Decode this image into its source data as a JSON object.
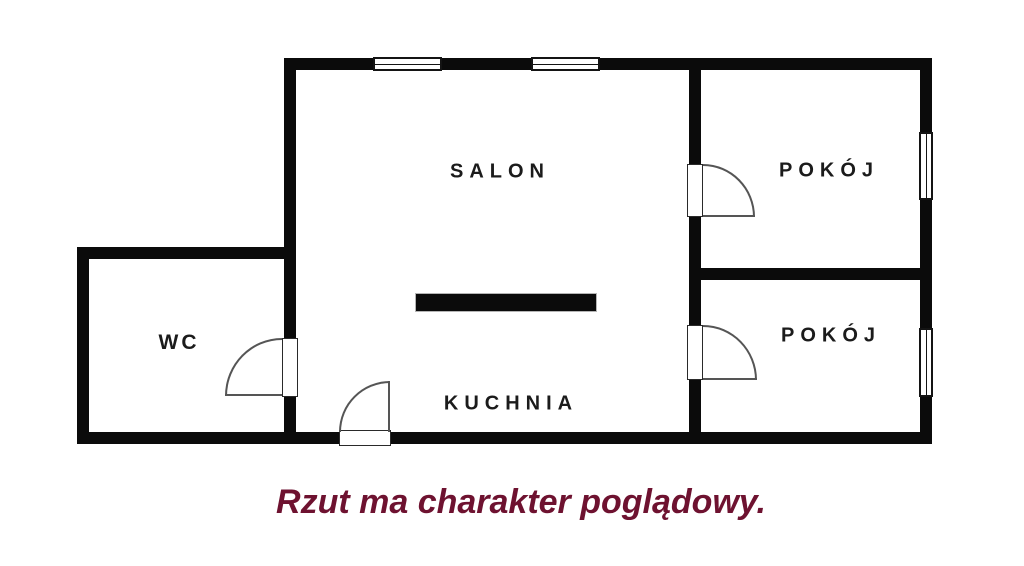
{
  "plan": {
    "rooms": {
      "salon": {
        "label": "SALON"
      },
      "kuchnia": {
        "label": "KUCHNIA"
      },
      "wc": {
        "label": "WC"
      },
      "pokoj1": {
        "label": "POKÓJ"
      },
      "pokoj2": {
        "label": "POKÓJ"
      }
    },
    "caption": "Rzut ma charakter poglądowy.",
    "colors": {
      "wall": "#0b0b0b",
      "background": "#ffffff",
      "room_label": "#1b1b1b",
      "caption": "#6e1230"
    },
    "symbols": {
      "windows": [
        "window-top-1",
        "window-top-2",
        "window-right-1",
        "window-right-2"
      ],
      "doors": [
        "door-wc",
        "door-entrance",
        "door-pokoj-1",
        "door-pokoj-2"
      ],
      "kitchen_bar": "kitchen-counter-bar"
    }
  }
}
